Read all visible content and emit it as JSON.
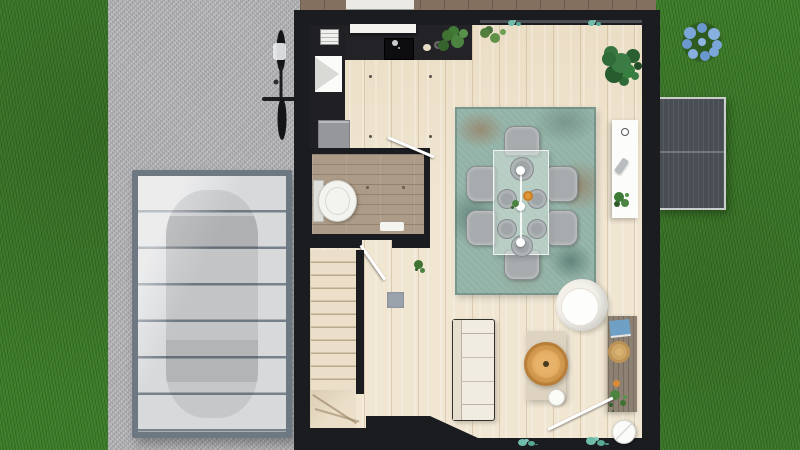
{
  "scene": {
    "description": "Top-down 3D architectural render of a house ground floor with lawn, gravel driveway, glass carport with parked car, bicycle, rear deck, garden shed and blue flower bush",
    "palette": {
      "grass": "#3f7e2b",
      "driveway_gravel": "#b5b5b8",
      "house_wall": "#1a1c20",
      "wood_floor": "#f0e6d2",
      "bathroom_floor": "#ac9b86",
      "deck_wood": "#84705f",
      "rug_teal": "#93b2a7",
      "dining_chair_gray": "#a7abad",
      "sofa_white": "#f1ece2",
      "rattan_tray": "#dfa95e",
      "side_table_wood": "#8d8173",
      "shed_gray": "#494d54",
      "carport_frame": "#6e7882",
      "carport_glass": "#d8d9db",
      "flower_blue": "#7ba6d9",
      "plant_green": "#2f6b38",
      "sill_plant_teal": "#6fbcab"
    },
    "yard": {
      "flower_bush": {
        "type": "blue flowering bush",
        "bloom_count": 9
      },
      "shed": {
        "type": "ribbed garden shed roof",
        "panel_split": 2
      }
    },
    "driveway": {
      "surface": "gravel",
      "bicycle_present": true,
      "carport": {
        "glass_panel_count": 7,
        "car_underneath": true
      }
    },
    "house": {
      "deck": {
        "furniture": "white outdoor table"
      },
      "kitchen": {
        "items": [
          "dark L-shaped counter",
          "black sink with chrome faucet",
          "white wall shelf",
          "white grill appliance",
          "white funnel fixture",
          "gray cabinet",
          "potted plant",
          "potted plant",
          "cream bowl",
          "black bowl"
        ],
        "ceiling_spot_count": 4
      },
      "dining": {
        "rug": "vintage teal patterned rug",
        "table": "glass dining table",
        "chair_count": 6,
        "place_setting_count": 6,
        "pendant_ball_count": 3,
        "decor": [
          "orange bowl",
          "green sprig"
        ]
      },
      "bathroom": {
        "items": [
          "white toilet",
          "white bath mat"
        ],
        "door_open": true,
        "spot_count": 2
      },
      "hall": {
        "items": [
          "gray door mat",
          "small plant"
        ],
        "door_open": true
      },
      "stairs": {
        "straight_step_count": 10,
        "winder_step_count": 3,
        "railing_wall": true
      },
      "living": {
        "items": [
          "white 3-seat sofa",
          "beige coffee table",
          "rattan tray",
          "white teapot",
          "white round armchair",
          "white console sideboard",
          "wood side table",
          "blue book stack",
          "straw hat",
          "trailing plant",
          "round floor lamp",
          "monstera plant"
        ],
        "entry_door_open": true
      },
      "window_sill_plant_groups": 4
    }
  }
}
